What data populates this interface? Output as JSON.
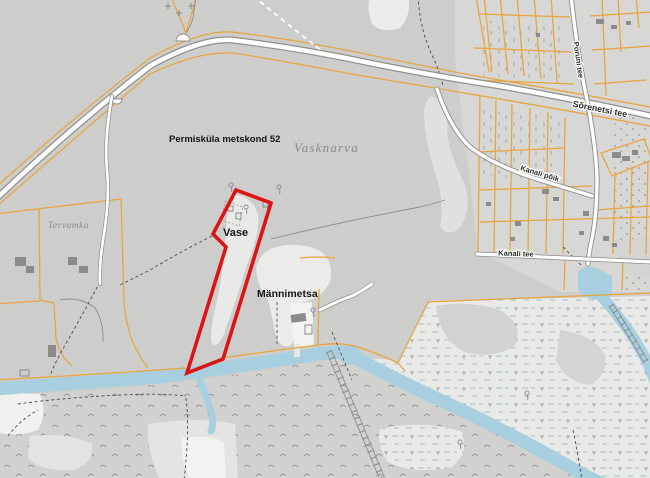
{
  "map": {
    "kind": "topographic-cadastral-map",
    "labels": {
      "forest_district": "Permisküla metskond 52",
      "settlement_name": "Vasknarva",
      "place_vase": "Vase",
      "place_mannimetsa": "Männimetsa",
      "place_tervamka": "Tervamka",
      "road_sorenetsi_tee": "Sõrenetsi tee",
      "road_poruni_tee": "Poruni tee",
      "road_kanali_poik": "Kanali põik",
      "road_kanali_tee": "Kanali tee"
    },
    "highlight": {
      "description": "selected cadastral parcel outline",
      "color": "#dc1414"
    },
    "colors": {
      "land": "#cdcdcb",
      "village_zone": "#d7d7d5",
      "open_light": "#e4e4e2",
      "open_white": "#f1f1ef",
      "marsh": "#d1d1cf",
      "reed_bg": "#e9eae8",
      "water": "#a7cfdf",
      "cadastral_line": "#e9a43c",
      "selection_outline": "#dc1414",
      "road_fill": "#ffffff",
      "road_casing": "#8e8e8c",
      "building": "#8b8b89",
      "path_dash": "#4a4a48",
      "gray_line": "#8f8f8d",
      "label_dark": "#151515",
      "label_gray": "#8b8b8b"
    }
  }
}
